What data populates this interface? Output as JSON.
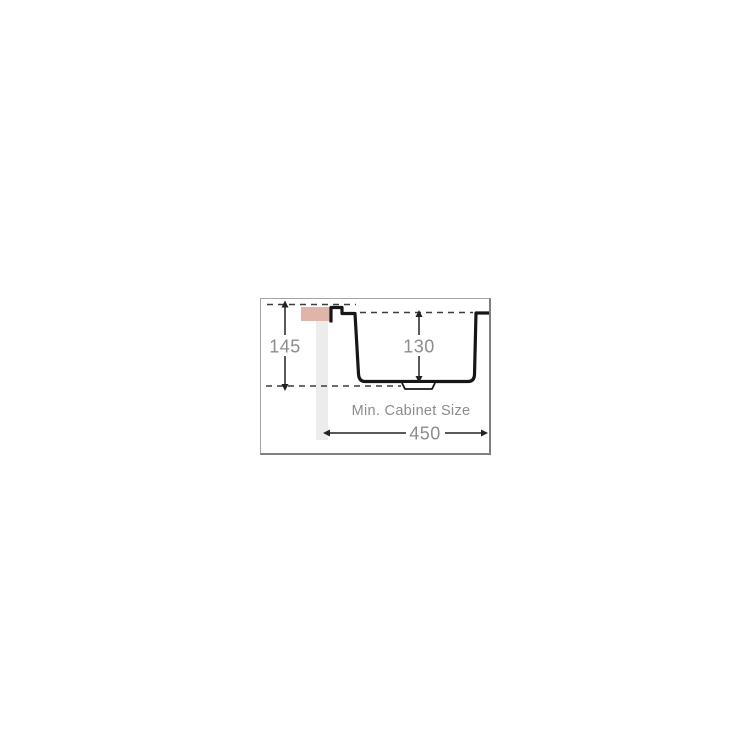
{
  "diagram": {
    "caption": "Min. Cabinet Size",
    "dimensions": {
      "overall_depth": "145",
      "bowl_depth": "130",
      "min_cabinet_width": "450"
    },
    "colors": {
      "countertop_fill": "#dfb4a9",
      "cabinet_panel_fill": "#ececec",
      "outline": "#161616",
      "label_text": "#8c8c8c",
      "datum_dash": "#3c3c3c",
      "panel_border_light": "#a3a3a3",
      "panel_border_dark": "#7f7f7f"
    }
  }
}
